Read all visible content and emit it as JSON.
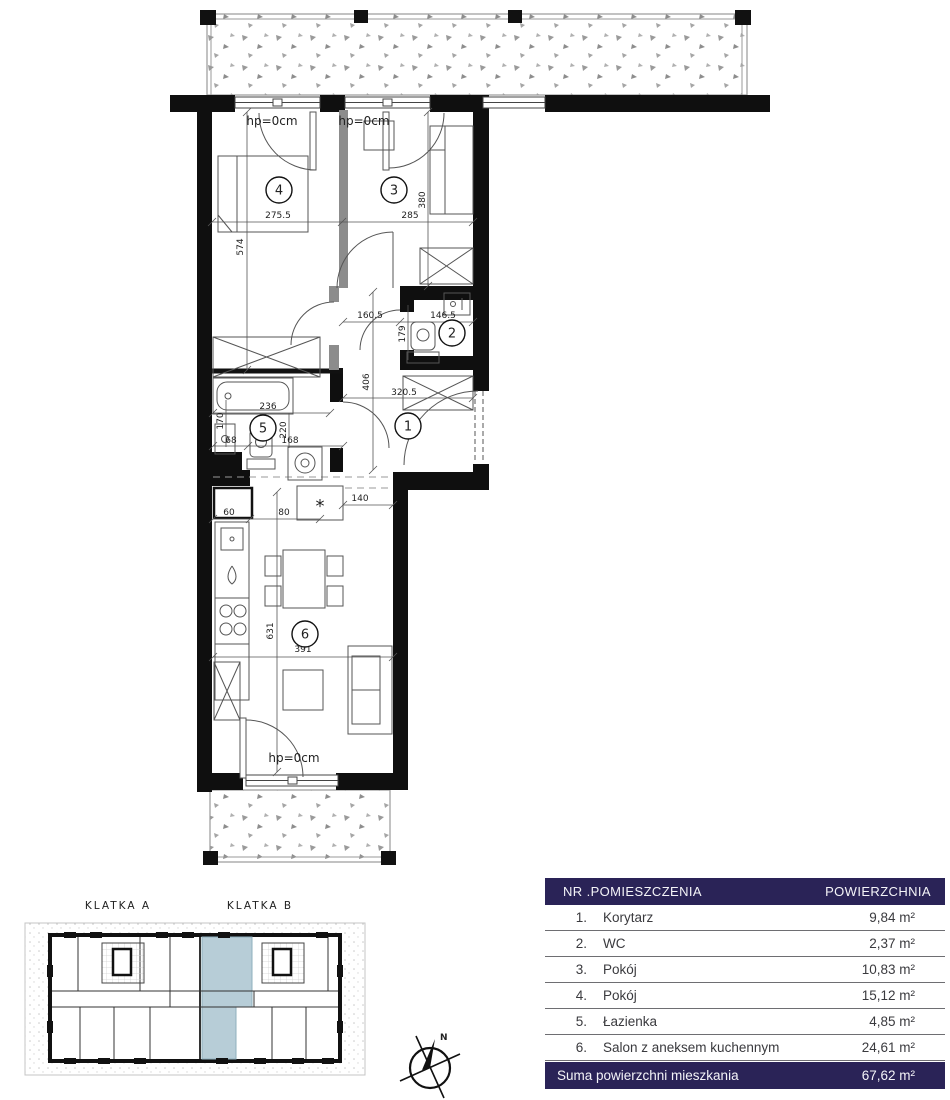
{
  "colors": {
    "accent_navy": "#2a2357",
    "unit_highlight": "#b7cdd7"
  },
  "plan": {
    "hp1": "hp=0cm",
    "hp2": "hp=0cm",
    "hp3": "hp=0cm",
    "star": "*",
    "room_numbers": {
      "r1": "1",
      "r2": "2",
      "r3": "3",
      "r4": "4",
      "r5": "5",
      "r6": "6"
    },
    "dims": {
      "w275": "275.5",
      "h574": "574",
      "w285": "285",
      "h380": "380",
      "w160": "160.5",
      "w146": "146.5",
      "h179": "179",
      "h406": "406",
      "w320": "320.5",
      "w236": "236",
      "h170": "170",
      "h220": "220",
      "w68": "68",
      "w168": "168",
      "w140": "140",
      "w60": "60",
      "w80": "80",
      "h631": "631",
      "w391": "391"
    }
  },
  "overview": {
    "klatka_a": "KLATKA A",
    "klatka_b": "KLATKA B"
  },
  "compass": {
    "north": "N"
  },
  "area_table": {
    "header": {
      "rooms_col": "NR .POMIESZCZENIA",
      "area_col": "POWIERZCHNIA"
    },
    "rows": [
      {
        "no": "1.",
        "name": "Korytarz",
        "area": "9,84 m²"
      },
      {
        "no": "2.",
        "name": "WC",
        "area": "2,37 m²"
      },
      {
        "no": "3.",
        "name": "Pokój",
        "area": "10,83 m²"
      },
      {
        "no": "4.",
        "name": "Pokój",
        "area": "15,12 m²"
      },
      {
        "no": "5.",
        "name": "Łazienka",
        "area": "4,85 m²"
      },
      {
        "no": "6.",
        "name": "Salon z aneksem kuchennym",
        "area": "24,61 m²"
      }
    ],
    "footer": {
      "label": "Suma powierzchni mieszkania",
      "value": "67,62 m²"
    }
  }
}
